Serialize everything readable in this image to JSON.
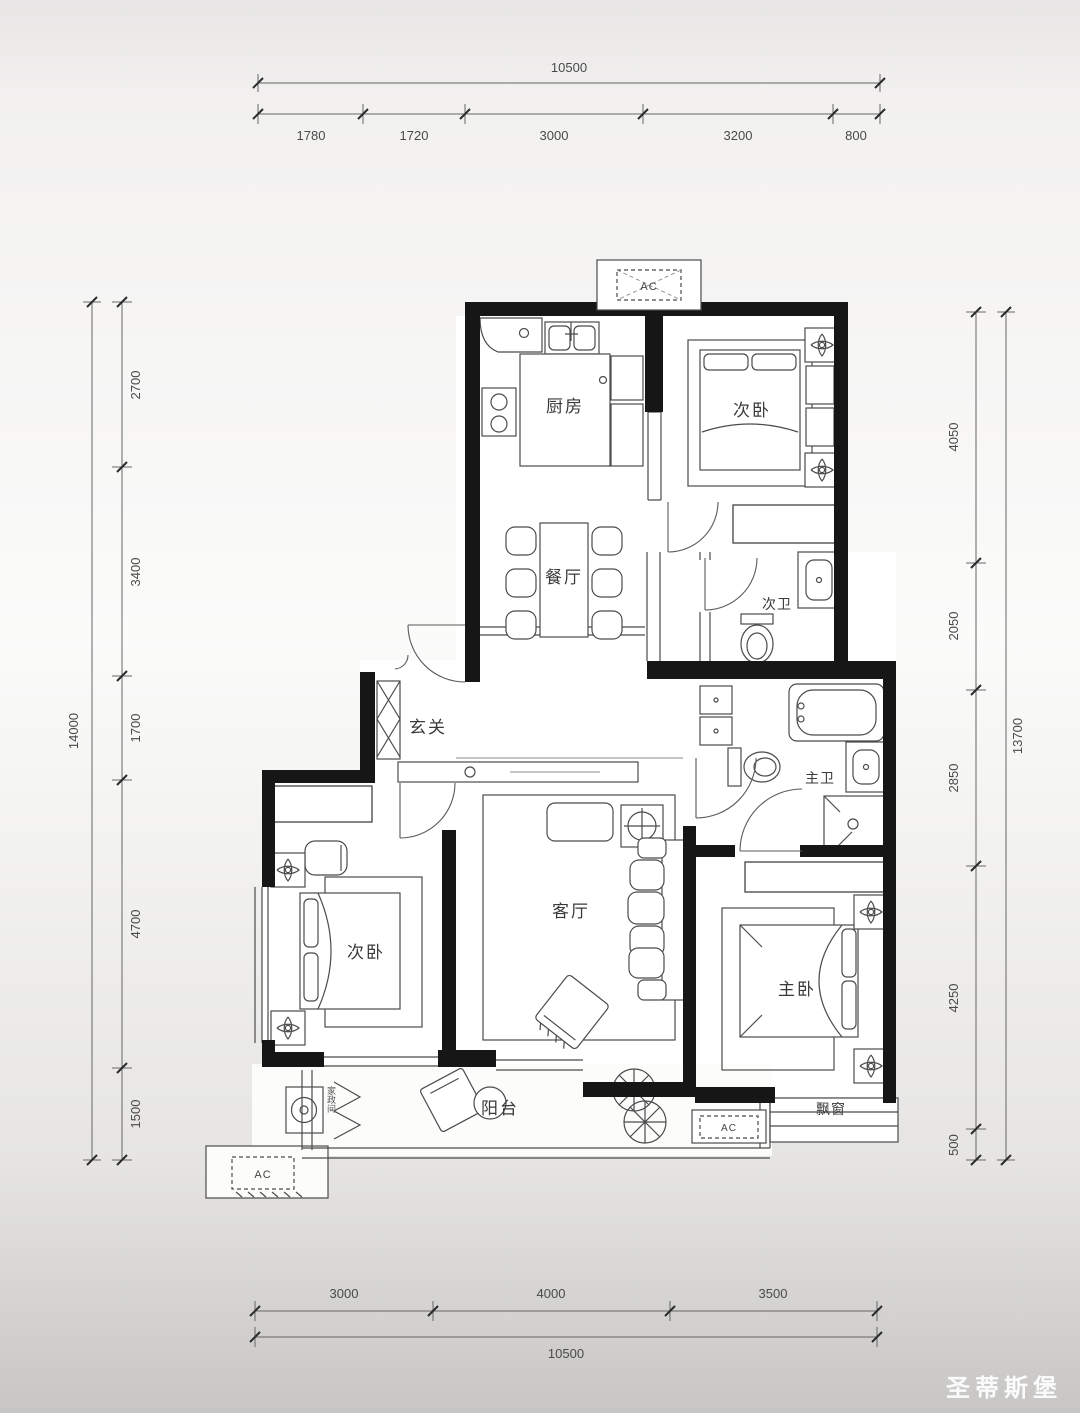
{
  "watermark": {
    "text": "圣蒂斯堡"
  },
  "rooms": {
    "kitchen": "厨房",
    "bedroom_top": "次卧",
    "dining": "餐厅",
    "bath2": "次卫",
    "foyer": "玄关",
    "bedroom_left": "次卧",
    "living": "客厅",
    "master_bath": "主卫",
    "master_bedroom": "主卧",
    "balcony": "阳台",
    "bay_window": "飘窗",
    "laundry": "家政间"
  },
  "ac": {
    "top": "AC",
    "bottom_left": "AC",
    "bottom_center": "AC"
  },
  "dimensions": {
    "top": {
      "total": "10500",
      "segments": [
        "1780",
        "1720",
        "3000",
        "3200",
        "800"
      ]
    },
    "bottom": {
      "total": "10500",
      "segments": [
        "3000",
        "4000",
        "3500"
      ]
    },
    "left": {
      "total": "14000",
      "segments": [
        "2700",
        "3400",
        "1700",
        "4700",
        "1500"
      ]
    },
    "right": {
      "total": "13700",
      "segments": [
        "4050",
        "2050",
        "2850",
        "4250",
        "500"
      ]
    }
  }
}
